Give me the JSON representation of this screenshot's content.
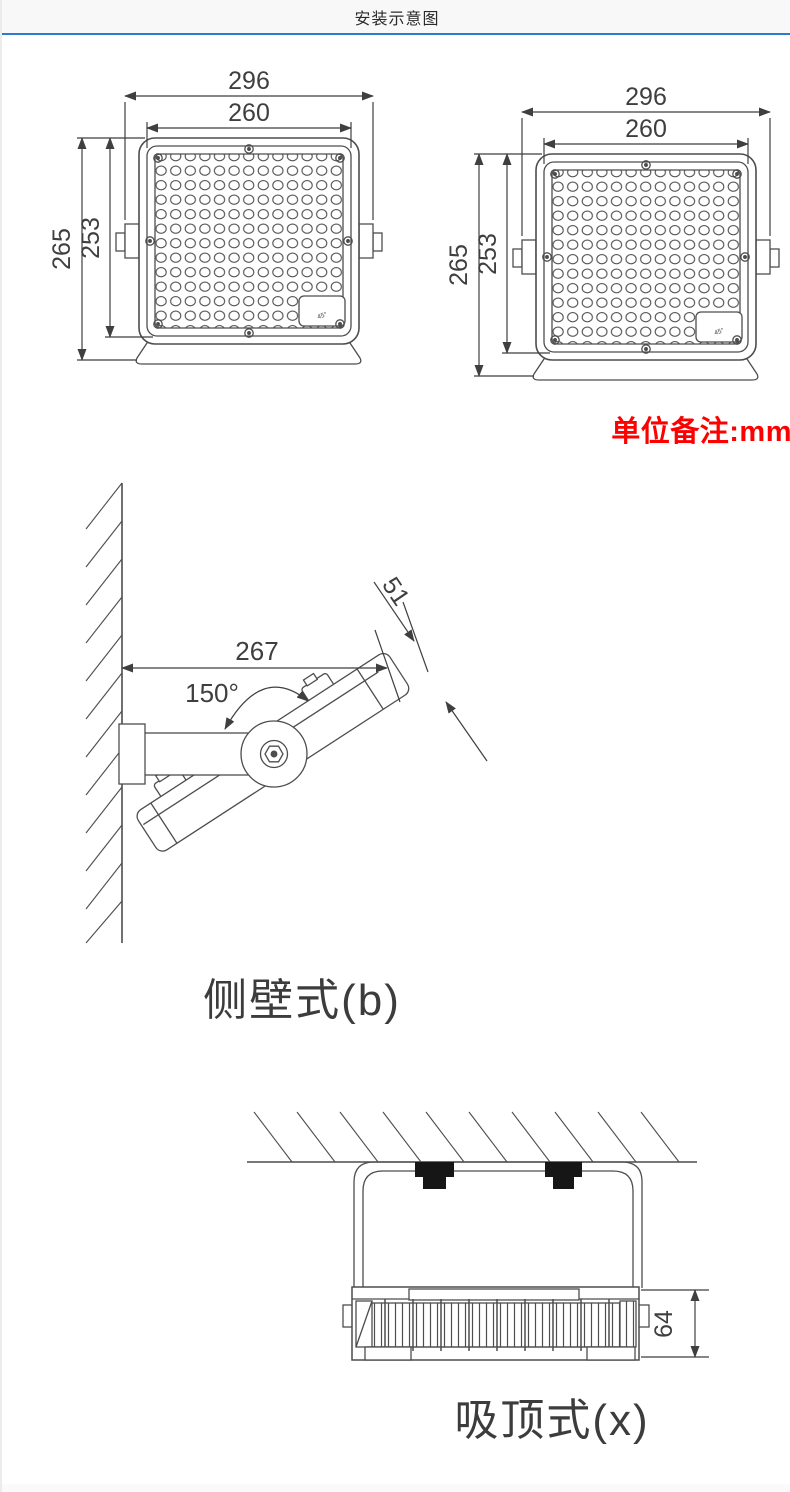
{
  "header": {
    "title": "安装示意图",
    "accent_color": "#2b7cd0"
  },
  "unit_note": {
    "text": "单位备注:mm",
    "color": "#fe0000"
  },
  "front_left": {
    "dim_width_outer": "296",
    "dim_width_inner": "260",
    "dim_height_outer": "265",
    "dim_height_inner": "253",
    "corner_label": "45°"
  },
  "front_right": {
    "dim_width_outer": "296",
    "dim_width_inner": "260",
    "dim_height_outer": "265",
    "dim_height_inner": "253",
    "corner_label": "45°"
  },
  "wall_mount": {
    "caption": "侧壁式(b)",
    "dim_reach": "267",
    "dim_end_offset": "51",
    "angle_label": "150°"
  },
  "ceiling_mount": {
    "caption": "吸顶式(x)",
    "dim_depth": "64"
  }
}
